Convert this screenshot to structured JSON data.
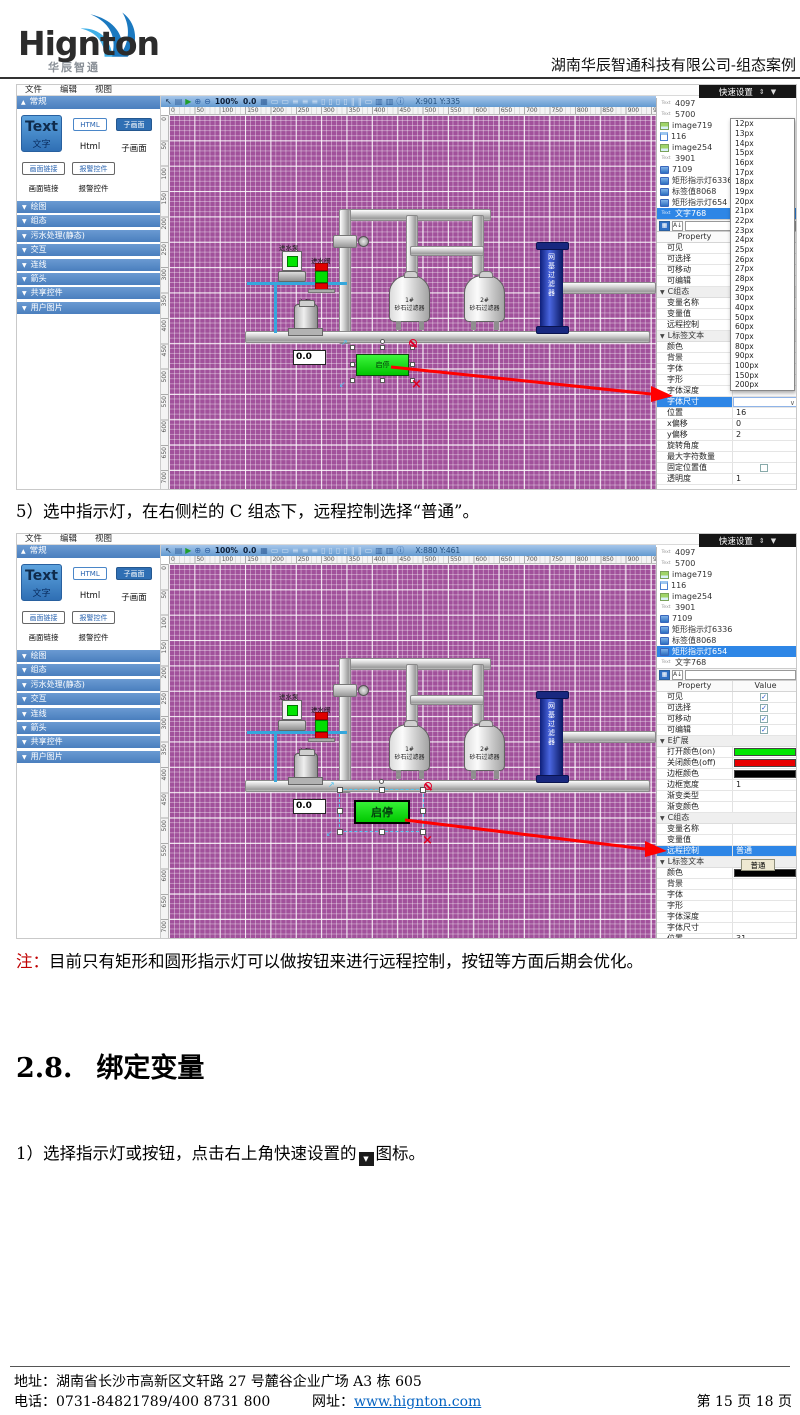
{
  "document": {
    "logo_text": "Hignton",
    "logo_sub": "华辰智通",
    "title_right": "湖南华辰智通科技有限公司-组态案例",
    "step5": "5）选中指示灯，在右侧栏的 C 组态下，远程控制选择“普通”。",
    "note_label": "注：",
    "note_body": "目前只有矩形和圆形指示灯可以做按钮来进行远程控制，按钮等方面后期会优化。",
    "heading_num": "2.8.",
    "heading_text": "绑定变量",
    "step1_prefix": "1）选择指示灯或按钮，点击右上角快速设置的",
    "step1_icon": "▼",
    "step1_suffix": "图标。",
    "footer_address": "地址：湖南省长沙市高新区文轩路 27 号麓谷企业广场 A3 栋 605",
    "footer_phone": "电话：0731-84821789/400 8731 800",
    "footer_web_label": "网址：",
    "footer_web": "www.hignton.com",
    "footer_page": "第 15 页 18 页"
  },
  "colors": {
    "selection_blue": "#2e86e6",
    "canvas_purple": "#a1519b",
    "on_green": "#00e800",
    "off_red": "#e80000",
    "border_black": "#000000",
    "arrow_red": "#ff0000",
    "link_blue": "#0563c1",
    "note_red": "#c00000"
  },
  "editor_common": {
    "menus": [
      "文件",
      "编辑",
      "视图"
    ],
    "quick_setup": "快速设置",
    "quick_icons": {
      "move": "⇕",
      "drop": "▼"
    },
    "toolbar": {
      "left_icons": [
        {
          "name": "cursor-tool-icon",
          "glyph": "↖",
          "color": "#17314f"
        },
        {
          "name": "save-icon",
          "glyph": "▤",
          "color": "#35639c"
        },
        {
          "name": "run-icon",
          "glyph": "▶",
          "color": "#1f9e2c"
        },
        {
          "name": "zoom-in-icon",
          "glyph": "⊕",
          "color": "#2d5f9e"
        },
        {
          "name": "zoom-out-icon",
          "glyph": "⊖",
          "color": "#2d5f9e"
        }
      ],
      "zoom_level": "100%",
      "zoom_offset": "0.0",
      "grid_icon": {
        "name": "grid-icon",
        "glyph": "▦",
        "color": "#35639c"
      },
      "disabled_glyphs": [
        "▭",
        "▭",
        "≡",
        "≡",
        "≡",
        "▯",
        "▯",
        "▯",
        "▯",
        "∥",
        "∥",
        "▭"
      ],
      "right_icons": [
        {
          "name": "image-tool-icon",
          "glyph": "▥",
          "color": "#35639c"
        },
        {
          "name": "image-tool-icon",
          "glyph": "▥",
          "color": "#35639c"
        },
        {
          "name": "info-icon",
          "glyph": "ⓘ",
          "color": "#2d5f9e"
        }
      ]
    },
    "left_panel": {
      "header": "常规",
      "tools": {
        "text_en": "Text",
        "text_cn": "文字",
        "html_btn": "HTML",
        "html_label": "Html",
        "sub_btn": "子画面",
        "sub_label": "子画面",
        "link_btn": "画面链接",
        "link_label": "画面链接",
        "alarm_btn": "报警控件",
        "alarm_label": "报警控件"
      },
      "sections": [
        "绘图",
        "组态",
        "污水处理(静态)",
        "交互",
        "连线",
        "箭头",
        "共享控件",
        "用户图片"
      ]
    },
    "ruler_h": [
      "0",
      "50",
      "100",
      "150",
      "200",
      "250",
      "300",
      "350",
      "400",
      "450",
      "500",
      "550",
      "600",
      "650",
      "700",
      "750",
      "800",
      "850",
      "900",
      "950"
    ],
    "ruler_v": [
      "0",
      "50",
      "100",
      "150",
      "200",
      "250",
      "300",
      "350",
      "400",
      "450",
      "500",
      "550",
      "600",
      "650",
      "700"
    ],
    "filter_icons": {
      "grid": "▦",
      "sort": "A↓"
    },
    "property_header": "Property",
    "value_header": "Value",
    "tree": [
      {
        "icon": "text",
        "label": "4097"
      },
      {
        "icon": "text",
        "label": "5700"
      },
      {
        "icon": "img",
        "label": "image719"
      },
      {
        "icon": "page",
        "label": "116"
      },
      {
        "icon": "img",
        "label": "image254"
      },
      {
        "icon": "text",
        "label": "3901"
      },
      {
        "icon": "disp",
        "label": "7109"
      },
      {
        "icon": "disp",
        "label": "矩形指示灯6336"
      },
      {
        "icon": "disp",
        "label": "标签值8068"
      },
      {
        "icon": "disp",
        "label": "矩形指示灯654"
      },
      {
        "icon": "text",
        "label": "文字768"
      }
    ],
    "scene": {
      "inlet_pump_label": "进水泵",
      "inlet_valve_label": "进水阀",
      "main_pump_label": "主泵",
      "tank1_no": "1#",
      "tank1_name": "砂石过滤器",
      "tank2_no": "2#",
      "tank2_name": "砂石过滤器",
      "blue_tank_label": "网基过滤器",
      "value_display": "0.0",
      "start_stop_button": "启停"
    }
  },
  "shot1": {
    "variant": "v1",
    "coords": "X:901 Y:335",
    "selected_tree": "文字768",
    "props": [
      {
        "name": "可见",
        "type": "check"
      },
      {
        "name": "可选择",
        "type": "check"
      },
      {
        "name": "可移动",
        "type": "check"
      },
      {
        "name": "可编辑",
        "type": "check"
      },
      {
        "name": "C组态",
        "type": "section"
      },
      {
        "name": "变量名称",
        "type": "blank"
      },
      {
        "name": "变量值",
        "type": "blank"
      },
      {
        "name": "远程控制",
        "type": "blank"
      },
      {
        "name": "L标签文本",
        "type": "section"
      },
      {
        "name": "颜色",
        "type": "blank"
      },
      {
        "name": "背景",
        "type": "blank"
      },
      {
        "name": "字体",
        "type": "blank"
      },
      {
        "name": "字形",
        "type": "blank"
      },
      {
        "name": "字体深度",
        "type": "blank"
      },
      {
        "name": "字体尺寸",
        "type": "selected",
        "chev": true
      },
      {
        "name": "位置",
        "type": "text",
        "value": "16"
      },
      {
        "name": "x偏移",
        "type": "text",
        "value": "0"
      },
      {
        "name": "y偏移",
        "type": "text",
        "value": "2"
      },
      {
        "name": "旋转角度",
        "type": "blank"
      },
      {
        "name": "最大字符数量",
        "type": "blank"
      },
      {
        "name": "固定位置值",
        "type": "checkbox"
      },
      {
        "name": "透明度",
        "type": "text",
        "value": "1"
      }
    ],
    "dropdown": [
      "12px",
      "13px",
      "14px",
      "15px",
      "16px",
      "17px",
      "18px",
      "19px",
      "20px",
      "21px",
      "22px",
      "23px",
      "24px",
      "25px",
      "26px",
      "27px",
      "28px",
      "29px",
      "30px",
      "40px",
      "50px",
      "60px",
      "70px",
      "80px",
      "90px",
      "100px",
      "150px",
      "200px"
    ]
  },
  "shot2": {
    "variant": "v2",
    "coords": "X:880 Y:461",
    "selected_tree": "矩形指示灯654",
    "chip": "普通",
    "props": [
      {
        "name": "可见",
        "type": "check"
      },
      {
        "name": "可选择",
        "type": "check"
      },
      {
        "name": "可移动",
        "type": "check"
      },
      {
        "name": "可编辑",
        "type": "check"
      },
      {
        "name": "E扩展",
        "type": "section"
      },
      {
        "name": "打开颜色(on)",
        "type": "swatch",
        "color": "#00e800"
      },
      {
        "name": "关闭颜色(off)",
        "type": "swatch",
        "color": "#e80000"
      },
      {
        "name": "边框颜色",
        "type": "swatch",
        "color": "#000000"
      },
      {
        "name": "边框宽度",
        "type": "text",
        "value": "1"
      },
      {
        "name": "渐变类型",
        "type": "blank"
      },
      {
        "name": "渐变颜色",
        "type": "blank"
      },
      {
        "name": "C组态",
        "type": "section"
      },
      {
        "name": "变量名称",
        "type": "blank"
      },
      {
        "name": "变量值",
        "type": "blank"
      },
      {
        "name": "远程控制",
        "type": "selected",
        "value": "普通"
      },
      {
        "name": "L标签文本",
        "type": "section"
      },
      {
        "name": "颜色",
        "type": "swatch",
        "color": "#000000"
      },
      {
        "name": "背景",
        "type": "blank"
      },
      {
        "name": "字体",
        "type": "blank"
      },
      {
        "name": "字形",
        "type": "blank"
      },
      {
        "name": "字体深度",
        "type": "blank"
      },
      {
        "name": "字体尺寸",
        "type": "blank"
      },
      {
        "name": "位置",
        "type": "text",
        "value": "31"
      }
    ]
  }
}
